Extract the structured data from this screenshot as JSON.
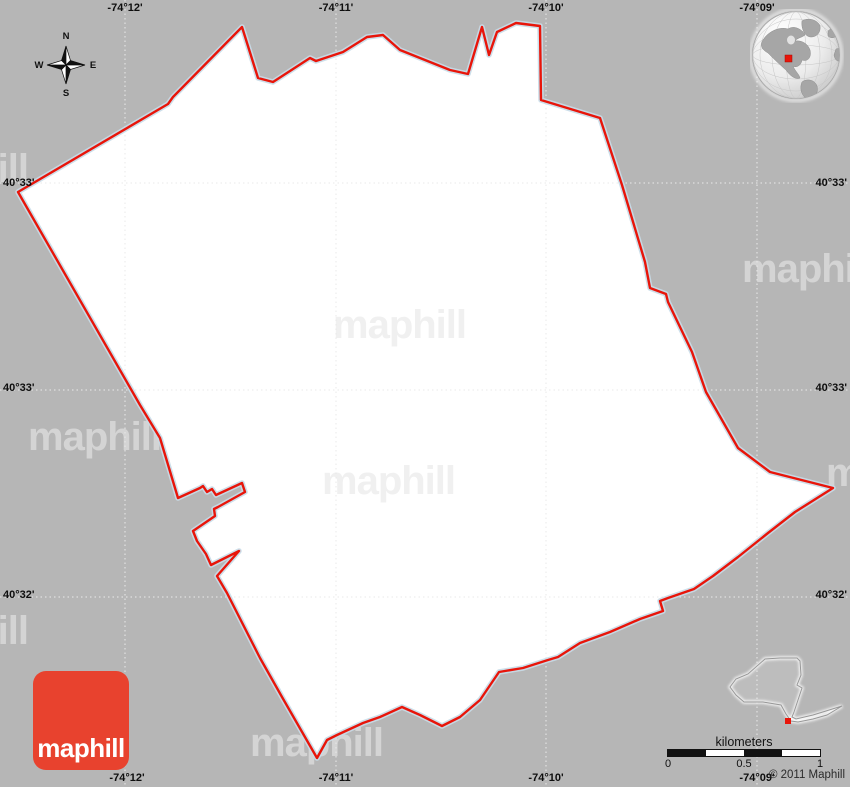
{
  "watermark": {
    "text": "maphill"
  },
  "brand": {
    "logo_text": "maphill"
  },
  "compass": {
    "north": "N",
    "east": "E",
    "south": "S",
    "west": "W"
  },
  "grid": {
    "top_labels": [
      "-74°12'",
      "-74°11'",
      "-74°10'",
      "-74°09'"
    ],
    "bottom_labels": [
      "-74°12'",
      "-74°11'",
      "-74°10'",
      "-74°09'"
    ],
    "left_labels": [
      "40°33'",
      "40°33'",
      "40°32'"
    ],
    "right_labels": [
      "40°33'",
      "40°33'",
      "40°32'"
    ]
  },
  "scale_bar": {
    "unit": "kilometers",
    "tick_labels": [
      "0",
      "0.5",
      "1"
    ]
  },
  "copyright": "© 2011 Maphill",
  "colors": {
    "background": "#b6b6b6",
    "map_fill": "#ffffff",
    "boundary": "#e8150a",
    "boundary_halo": "#c8dce8",
    "logo_red": "#e8422e",
    "marker_red": "#e8150a"
  }
}
